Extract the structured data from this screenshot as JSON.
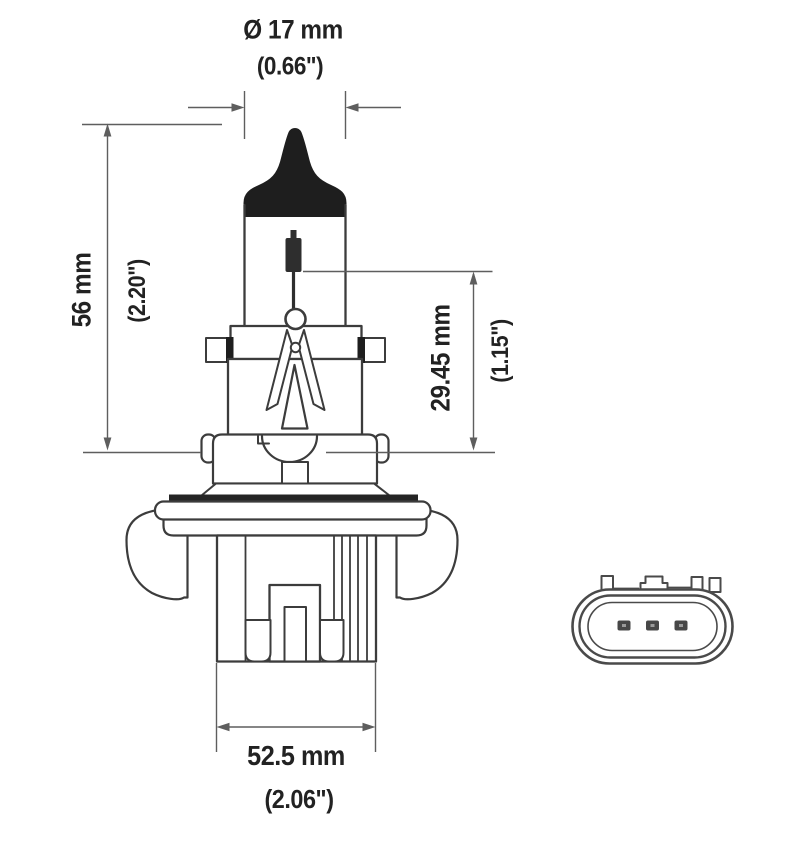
{
  "drawing": {
    "type": "technical-diagram",
    "subject": "halogen headlamp bulb side view with base connector face view",
    "labels": {
      "diameter_metric": "Ø 17 mm",
      "diameter_imperial": "(0.66\")",
      "length_metric": "56 mm",
      "length_imperial": "(2.20\")",
      "filament_metric": "29.45 mm",
      "filament_imperial": "(1.15\")",
      "base_metric": "52.5 mm",
      "base_imperial": "(2.06\")"
    },
    "colors": {
      "background": "#ffffff",
      "outline": "#3c3c3c",
      "dimension_line": "#5e5e5e",
      "black_fill": "#1e1e1e",
      "connector_outline": "#4a4a4a",
      "text": "#222222"
    }
  }
}
